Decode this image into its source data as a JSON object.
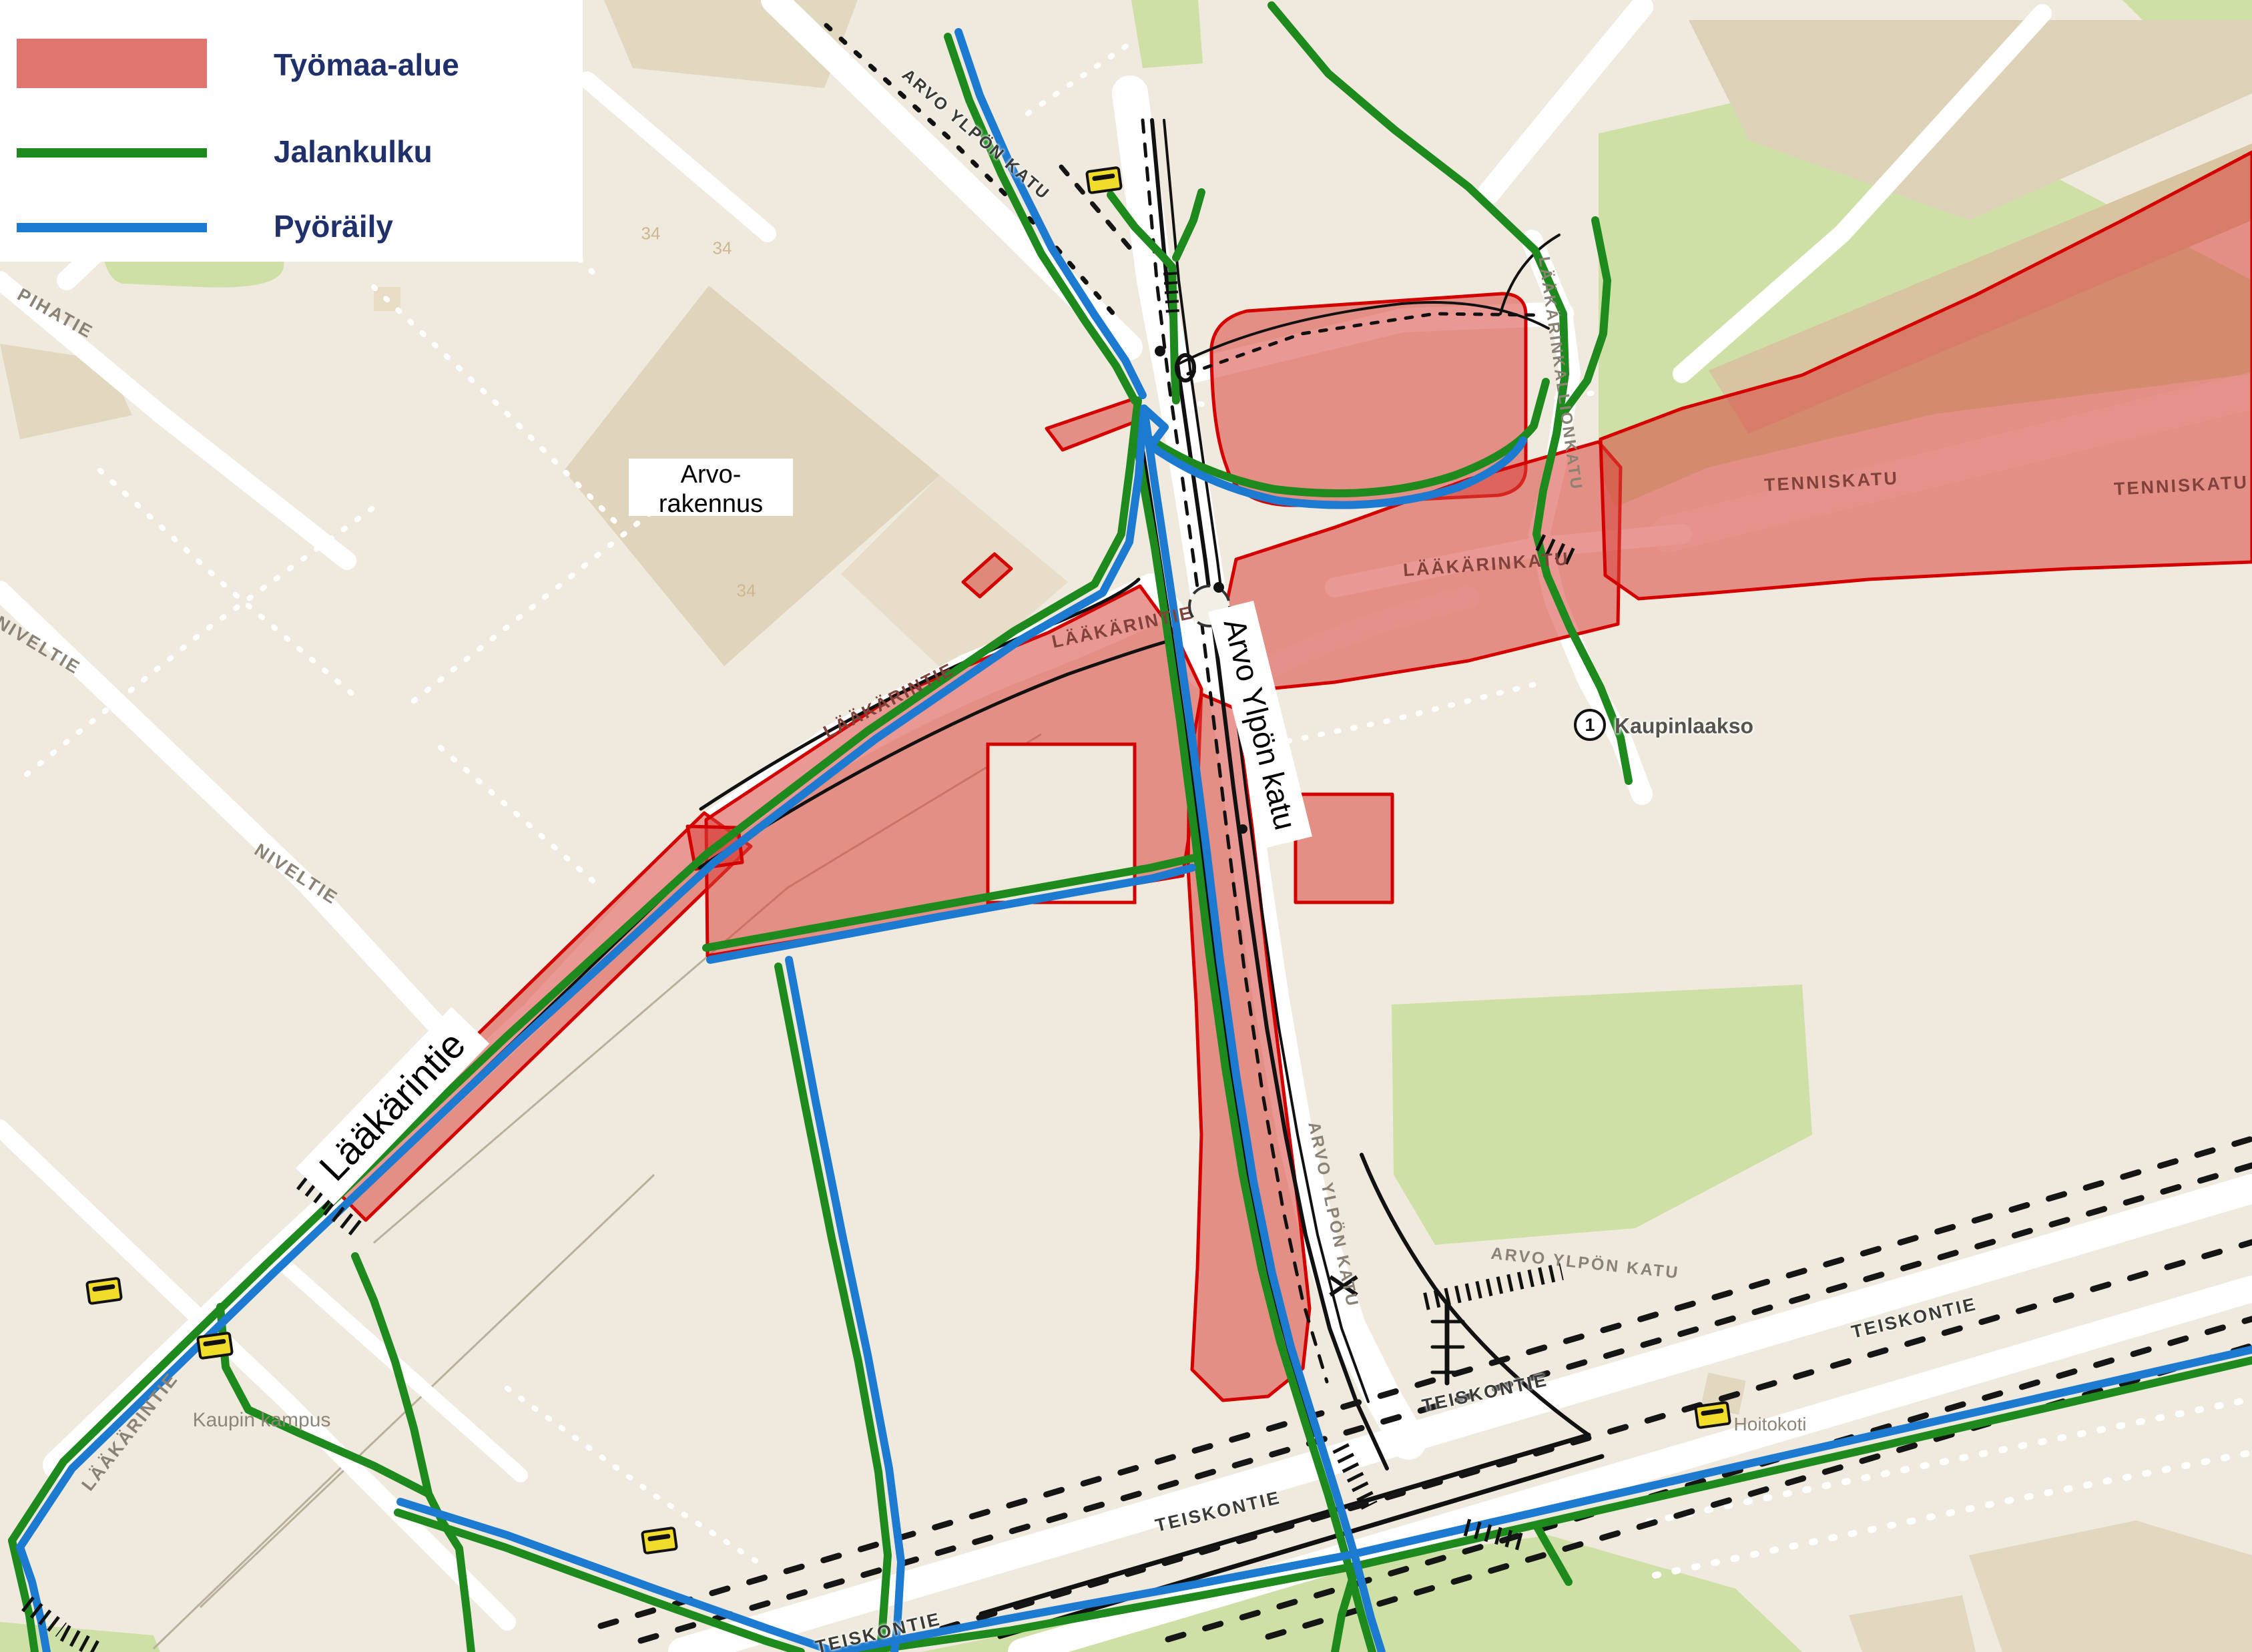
{
  "legend": {
    "items": [
      {
        "label": "Työmaa-alue",
        "type": "area",
        "color": "#e0756f"
      },
      {
        "label": "Jalankulku",
        "type": "line",
        "color": "#1e8a1e"
      },
      {
        "label": "Pyöräily",
        "type": "line",
        "color": "#1c7ad0"
      }
    ]
  },
  "map": {
    "colors": {
      "background": "#efeadd",
      "building": "#e2d7bf",
      "park": "#cfe0a6",
      "construction_fill": "#e08078",
      "construction_border": "#d40000",
      "pedestrian": "#1e8a1e",
      "cycling": "#1c7ad0",
      "road": "#ffffff"
    },
    "labels": [
      {
        "id": "pihatie",
        "text": "PIHATIE"
      },
      {
        "id": "niveltie-a",
        "text": "NIVELTIE"
      },
      {
        "id": "niveltie-b",
        "text": "NIVELTIE"
      },
      {
        "id": "laakarintie-big",
        "text": "Lääkärintie"
      },
      {
        "id": "laakarintie-cap-a",
        "text": "LÄÄKÄRINTIE"
      },
      {
        "id": "laakarintie-cap-b",
        "text": "LÄÄKÄRINTIE"
      },
      {
        "id": "laakarintie-cap-c",
        "text": "LÄÄKÄRINTIE"
      },
      {
        "id": "arvo-ylpon-katu-top",
        "text": "ARVO YLPÖN KATU"
      },
      {
        "id": "arvo-ylpon-katu-big",
        "text": "Arvo Ylpön katu"
      },
      {
        "id": "arvo-ylpon-katu-mid",
        "text": "ARVO YLPÖN KATU"
      },
      {
        "id": "arvo-ylpon-katu-right",
        "text": "ARVO YLPÖN KATU"
      },
      {
        "id": "laakarinkatu",
        "text": "LÄÄKÄRINKATU"
      },
      {
        "id": "laakarinkallionkatu",
        "text": "LÄÄKÄRINKALLIONKATU"
      },
      {
        "id": "tenniskatu-a",
        "text": "TENNISKATU"
      },
      {
        "id": "tenniskatu-b",
        "text": "TENNISKATU"
      },
      {
        "id": "teiskontie-a",
        "text": "TEISKONTIE"
      },
      {
        "id": "teiskontie-b",
        "text": "TEISKONTIE"
      },
      {
        "id": "teiskontie-c",
        "text": "TEISKONTIE"
      },
      {
        "id": "teiskontie-d",
        "text": "TEISKONTIE"
      },
      {
        "id": "kaupin-kampus",
        "text": "Kaupin kampus"
      },
      {
        "id": "hoitokoti",
        "text": "Hoitokoti"
      },
      {
        "id": "kaupinlaakso",
        "text": "Kaupinlaakso"
      },
      {
        "id": "building-34-a",
        "text": "34"
      },
      {
        "id": "building-34-b",
        "text": "34"
      },
      {
        "id": "building-34-c",
        "text": "34"
      }
    ],
    "arvo_rakennus": {
      "line1": "Arvo-",
      "line2": "rakennus"
    },
    "marker": {
      "number": "1"
    }
  }
}
